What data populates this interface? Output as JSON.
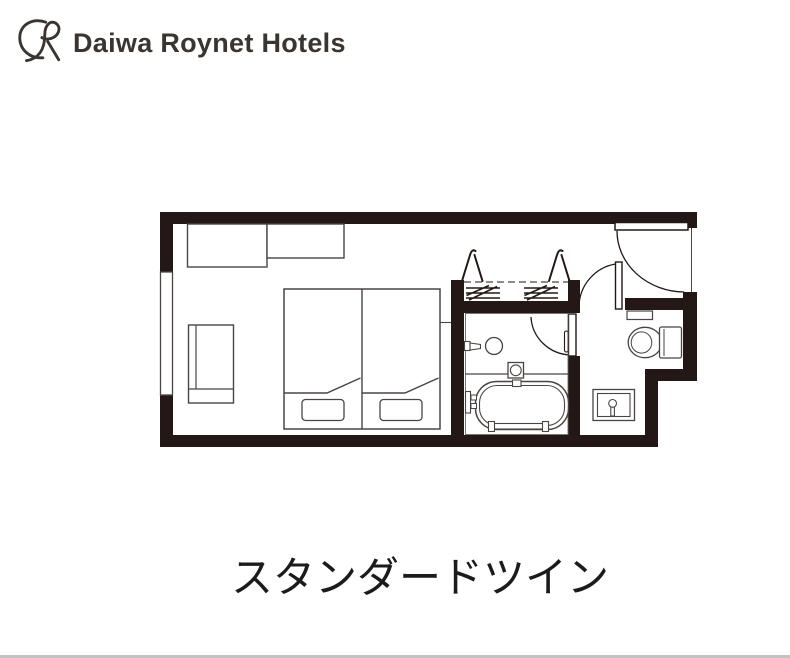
{
  "logo": {
    "brand_text": "Daiwa Roynet Hotels",
    "mark": "daiwa-roynet-monogram",
    "color": "#3a3531"
  },
  "room_type_label": "スタンダードツイン",
  "floor_plan": {
    "ink_color": "#231815",
    "line_color": "#4a4543",
    "features": [
      "window",
      "desk",
      "tv-counter",
      "lounge-chair",
      "twin-bed-left",
      "twin-bed-right",
      "pillow-left",
      "pillow-right",
      "closet-hanger-rod",
      "clothes-hanger",
      "clothes-hanger",
      "luggage-shelf",
      "luggage-shelf",
      "entrance-door",
      "hall-door",
      "bathroom-door",
      "washbasin",
      "washbasin-faucet",
      "bath-stool",
      "bathtub",
      "bathtub-faucet",
      "bathtub-handrail",
      "toilet",
      "toilet-shelf",
      "vanity-sink"
    ]
  }
}
